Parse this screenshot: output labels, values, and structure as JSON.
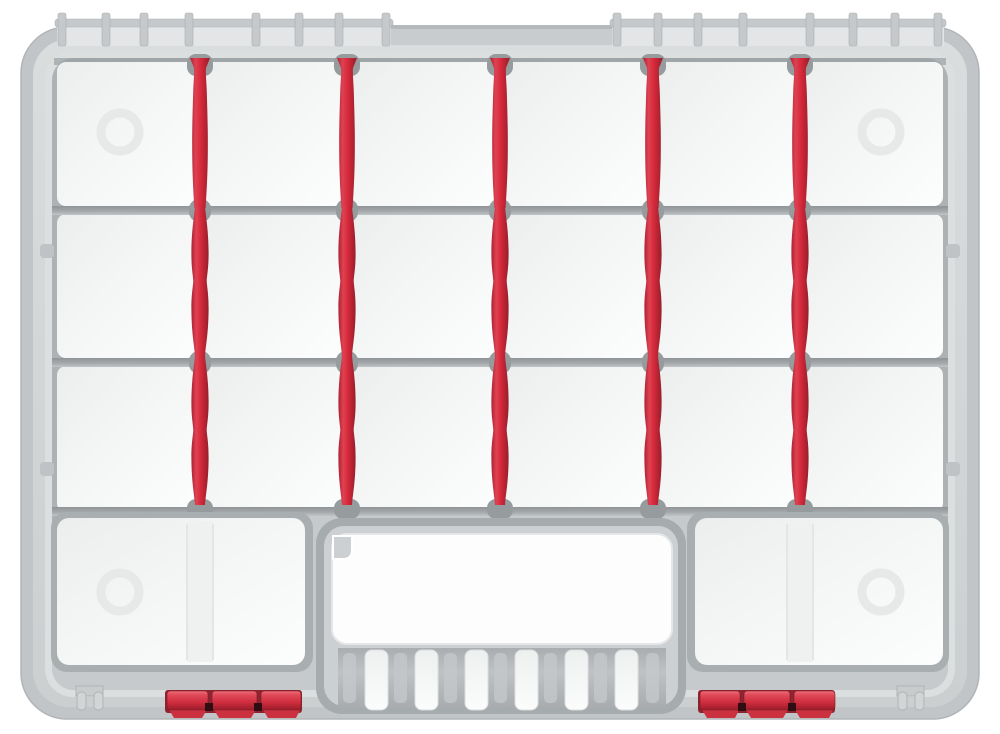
{
  "object": {
    "label": "gray parts organizer case with red dividers, closed lid, top view",
    "lid_state": "closed",
    "grid": {
      "rows": 3,
      "columns_per_row": 6,
      "dividers_per_row": 5,
      "divider_total": 15
    },
    "bottom_row": {
      "large_bins": 2,
      "embossed_circles": 4,
      "unused_divider_slots": 2
    },
    "handle": {
      "cutout": 1,
      "grip_slats": 6,
      "corner_notch": 1
    },
    "latches": {
      "count": 2,
      "segments_each": 3
    },
    "hinges": {
      "left_posts": 8,
      "right_posts": 8,
      "center_bar": 1
    },
    "feet": {
      "count": 2,
      "prongs_each": 2
    }
  },
  "colors": {
    "page_bg": "#ffffff",
    "case_outer": "#c2c5c7",
    "lid": "#d4d7d8",
    "lid_inner": "#dcdfe0",
    "well": "#aeb2b4",
    "rail_dark": "#9aa0a2",
    "bottom_band": "#c7cacc",
    "tile_white": "#f4f5f5",
    "emboss_ring": "#e7e9e9",
    "notch_gray": "#969c9e",
    "channel_gray": "#a6abad",
    "rib_bg": "#b4b8ba",
    "stripe_gray": "#c5c8ca",
    "hinge_gray": "#c6c9cb",
    "hinge_panel": "#e3e5e6",
    "divider_red": "#d5293a",
    "latch_red": "#cf2d3e",
    "latch_dark": "#8e2430",
    "skirt_red": "#cc3140",
    "gap_dark": "#2f0e13",
    "foot_gray": "#d2d5d6",
    "cutout_white": "#fdfdfd"
  }
}
